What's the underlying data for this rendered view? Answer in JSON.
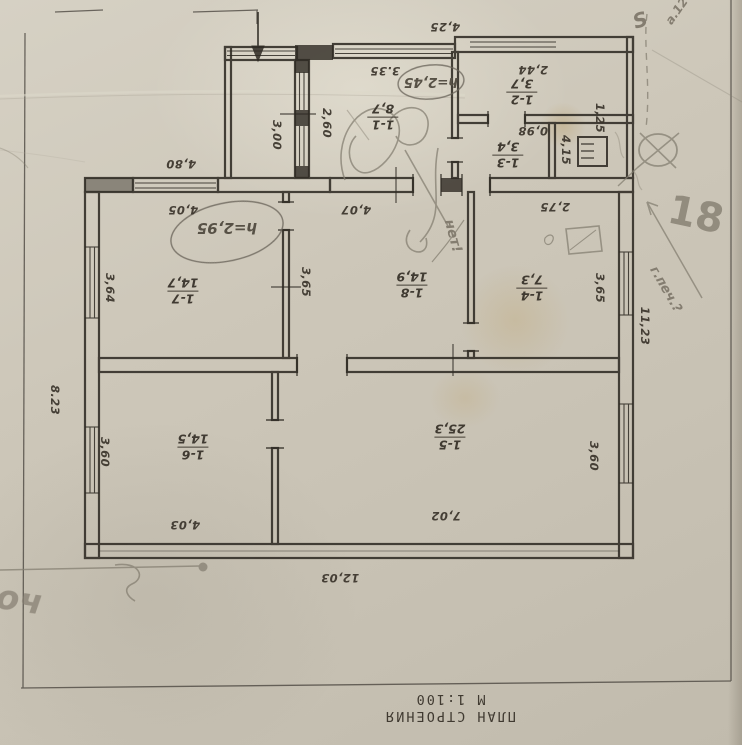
{
  "document": {
    "type_label": "ПЛАН СТРОЕНИЯ",
    "scale_label": "М 1:100"
  },
  "rooms": [
    {
      "number": "1-1",
      "area": "8,7"
    },
    {
      "number": "1-2",
      "area": "3,7"
    },
    {
      "number": "1-3",
      "area": "3,4"
    },
    {
      "number": "1-4",
      "area": "7,3"
    },
    {
      "number": "1-5",
      "area": "25,3"
    },
    {
      "number": "1-6",
      "area": "14,5"
    },
    {
      "number": "1-7",
      "area": "14,7"
    },
    {
      "number": "1-8",
      "area": "14,9"
    }
  ],
  "dimensions": {
    "upper_block_top": "4,25",
    "porch_side": "3,00",
    "porch_inner": "2,60",
    "left_wing_top": "4,80",
    "room_1_1_width": "3.35",
    "room_1_2_width": "2,44",
    "room_1_2_side": "1,25",
    "room_1_3_width": "0,98",
    "stove_room_side": "4,15",
    "room_1_4_width": "2,75",
    "room_1_4_side": "3,65",
    "room_1_7_width": "4,05",
    "room_1_7_side": "3,64",
    "room_1_8_width": "4,07",
    "room_1_8_side": "3,65",
    "room_1_5_width": "7,02",
    "room_1_5_side": "3,60",
    "room_1_6_width": "4,03",
    "room_1_6_side": "3,60",
    "house_left_side": "8.23",
    "house_right_side": "11,23",
    "house_bottom_width": "12,03"
  },
  "handwritten": {
    "height_note_upper": "h=2,45",
    "height_note_main": "h=2,95",
    "pencil_number": "18",
    "pencil_stove_query": "г.печ.?",
    "pencil_no_note": "нет!",
    "pencil_corner_note": "а.12",
    "pencil_s_mark": "S",
    "pencil_bottom_scrawl": "оч"
  }
}
